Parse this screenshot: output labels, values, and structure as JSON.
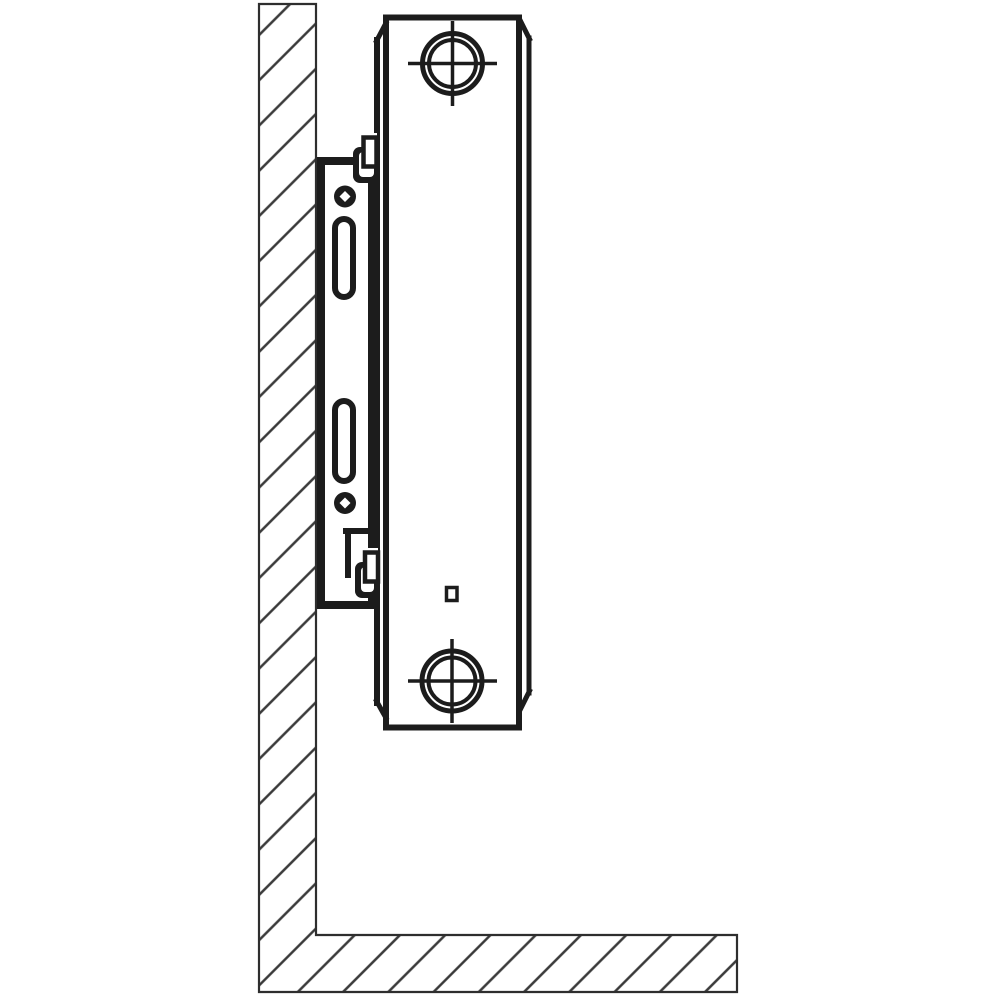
{
  "canvas": {
    "width": 1000,
    "height": 1000
  },
  "palette": {
    "ink": "#1c1c1c",
    "paper": "#ffffff",
    "wall_line": "#2e2e2e",
    "hatch": "#3a3a3a"
  },
  "hatch_pattern": {
    "spacing": 32,
    "angle": -45,
    "line_width": 2.4
  },
  "components": {
    "wall": "hatched-wall-section",
    "floor": "hatched-floor-section",
    "bracket": "wall-mounting-bracket",
    "radiator": "panel-radiator-side-view"
  },
  "shapes": [
    {
      "name": "wall-floor-structure",
      "type": "path",
      "d": "M 259 4 L 316 4 L 316 935 L 737 935 L 737 992 L 259 992 Z",
      "fill": "pattern:hatch",
      "stroke": "wall_line",
      "sw": 2.2
    },
    {
      "name": "bracket-plate",
      "type": "rect",
      "x": 321,
      "y": 161,
      "w": 51,
      "h": 444,
      "fill": "paper",
      "stroke": "ink",
      "sw": 8
    },
    {
      "name": "radiator-body",
      "type": "rect",
      "x": 386,
      "y": 17.5,
      "w": 133,
      "h": 710,
      "fill": "paper",
      "stroke": "ink",
      "sw": 6
    },
    {
      "name": "radiator-back-edge",
      "type": "line",
      "x1": 377,
      "y1": 40,
      "x2": 377,
      "y2": 703,
      "stroke": "ink",
      "sw": 6,
      "cap": "square"
    },
    {
      "name": "radiator-back-top-chamfer",
      "type": "line",
      "x1": 376.5,
      "y1": 41,
      "x2": 386,
      "y2": 23,
      "stroke": "ink",
      "sw": 5,
      "cap": "square"
    },
    {
      "name": "radiator-back-bottom-chamfer",
      "type": "line",
      "x1": 376.5,
      "y1": 701,
      "x2": 386,
      "y2": 718,
      "stroke": "ink",
      "sw": 5,
      "cap": "square"
    },
    {
      "name": "radiator-front-edge",
      "type": "line",
      "x1": 529,
      "y1": 38,
      "x2": 529,
      "y2": 693,
      "stroke": "ink",
      "sw": 5,
      "cap": "square"
    },
    {
      "name": "radiator-front-top-chamfer",
      "type": "line",
      "x1": 519.5,
      "y1": 19,
      "x2": 529.5,
      "y2": 39,
      "stroke": "ink",
      "sw": 5,
      "cap": "square"
    },
    {
      "name": "radiator-front-bottom-chamfer",
      "type": "line",
      "x1": 529.5,
      "y1": 691,
      "x2": 520,
      "y2": 710,
      "stroke": "ink",
      "sw": 5,
      "cap": "square"
    },
    {
      "name": "top-connection-outer-ring",
      "type": "circle",
      "cx": 452.5,
      "cy": 63.5,
      "r": 30,
      "fill": "none",
      "stroke": "ink",
      "sw": 5
    },
    {
      "name": "top-connection-inner-ring",
      "type": "circle",
      "cx": 452.5,
      "cy": 63.5,
      "r": 23.5,
      "fill": "none",
      "stroke": "ink",
      "sw": 4
    },
    {
      "name": "top-connection-crosshair-h",
      "type": "line",
      "x1": 408,
      "y1": 63.5,
      "x2": 497,
      "y2": 63.5,
      "stroke": "ink",
      "sw": 3.5
    },
    {
      "name": "top-connection-crosshair-v",
      "type": "line",
      "x1": 452.5,
      "y1": 21,
      "x2": 452.5,
      "y2": 106,
      "stroke": "ink",
      "sw": 3.5
    },
    {
      "name": "bottom-connection-outer-ring",
      "type": "circle",
      "cx": 452,
      "cy": 681,
      "r": 30,
      "fill": "none",
      "stroke": "ink",
      "sw": 5
    },
    {
      "name": "bottom-connection-inner-ring",
      "type": "circle",
      "cx": 452,
      "cy": 681,
      "r": 23.5,
      "fill": "none",
      "stroke": "ink",
      "sw": 4
    },
    {
      "name": "bottom-connection-crosshair-h",
      "type": "line",
      "x1": 408,
      "y1": 681,
      "x2": 497,
      "y2": 681,
      "stroke": "ink",
      "sw": 3.5
    },
    {
      "name": "bottom-connection-crosshair-v",
      "type": "line",
      "x1": 452,
      "y1": 639,
      "x2": 452,
      "y2": 723,
      "stroke": "ink",
      "sw": 3.5
    },
    {
      "name": "air-vent-square",
      "type": "rect",
      "x": 446.5,
      "y": 587.5,
      "w": 10.5,
      "h": 13,
      "fill": "paper",
      "stroke": "ink",
      "sw": 3.5
    },
    {
      "name": "bracket-notch-top-edge",
      "type": "rect",
      "x": 343,
      "y": 528,
      "w": 37,
      "h": 6,
      "fill": "ink"
    },
    {
      "name": "bracket-notch-left-edge",
      "type": "rect",
      "x": 345,
      "y": 528,
      "w": 6,
      "h": 50,
      "fill": "ink"
    },
    {
      "name": "top-retaining-clip-body",
      "type": "rect",
      "x": 353,
      "y": 147,
      "w": 27,
      "h": 36,
      "rx": 7,
      "fill": "ink"
    },
    {
      "name": "top-retaining-clip-slot",
      "type": "rect",
      "x": 359,
      "y": 152,
      "w": 15,
      "h": 25,
      "rx": 4,
      "fill": "paper"
    },
    {
      "name": "top-retaining-clip-opening",
      "type": "rect",
      "x": 362,
      "y": 133,
      "w": 15,
      "h": 30,
      "fill": "paper"
    },
    {
      "name": "top-retaining-clip-tab",
      "type": "rect",
      "x": 363.5,
      "y": 137.5,
      "w": 13,
      "h": 29,
      "fill": "paper",
      "stroke": "ink",
      "sw": 4.5
    },
    {
      "name": "bottom-retaining-clip-body",
      "type": "rect",
      "x": 355,
      "y": 562,
      "w": 25,
      "h": 36,
      "rx": 7,
      "fill": "ink"
    },
    {
      "name": "bottom-retaining-clip-slot",
      "type": "rect",
      "x": 361,
      "y": 567,
      "w": 13,
      "h": 25,
      "rx": 4,
      "fill": "paper"
    },
    {
      "name": "bottom-retaining-clip-opening",
      "type": "rect",
      "x": 364,
      "y": 548,
      "w": 14,
      "h": 30,
      "fill": "paper"
    },
    {
      "name": "bottom-retaining-clip-tab",
      "type": "rect",
      "x": 365,
      "y": 552.5,
      "w": 13,
      "h": 29,
      "fill": "paper",
      "stroke": "ink",
      "sw": 4.5
    },
    {
      "name": "bracket-screw-hole-top",
      "type": "circle",
      "cx": 345,
      "cy": 196.5,
      "r": 11,
      "fill": "ink"
    },
    {
      "name": "bracket-screw-hole-top-center",
      "type": "path",
      "d": "M 345 191 L 350.5 196.5 L 345 202 L 339.5 196.5 Z",
      "fill": "paper"
    },
    {
      "name": "bracket-slot-upper",
      "type": "rect",
      "x": 335,
      "y": 219,
      "w": 18,
      "h": 78,
      "rx": 9,
      "fill": "paper",
      "stroke": "ink",
      "sw": 6
    },
    {
      "name": "bracket-slot-lower",
      "type": "rect",
      "x": 335,
      "y": 401,
      "w": 18,
      "h": 80,
      "rx": 9,
      "fill": "paper",
      "stroke": "ink",
      "sw": 6
    },
    {
      "name": "bracket-screw-hole-bottom",
      "type": "circle",
      "cx": 345,
      "cy": 503,
      "r": 11,
      "fill": "ink"
    },
    {
      "name": "bracket-screw-hole-bottom-center",
      "type": "path",
      "d": "M 345 497.5 L 350.5 503 L 345 508.5 L 339.5 503 Z",
      "fill": "paper"
    }
  ]
}
